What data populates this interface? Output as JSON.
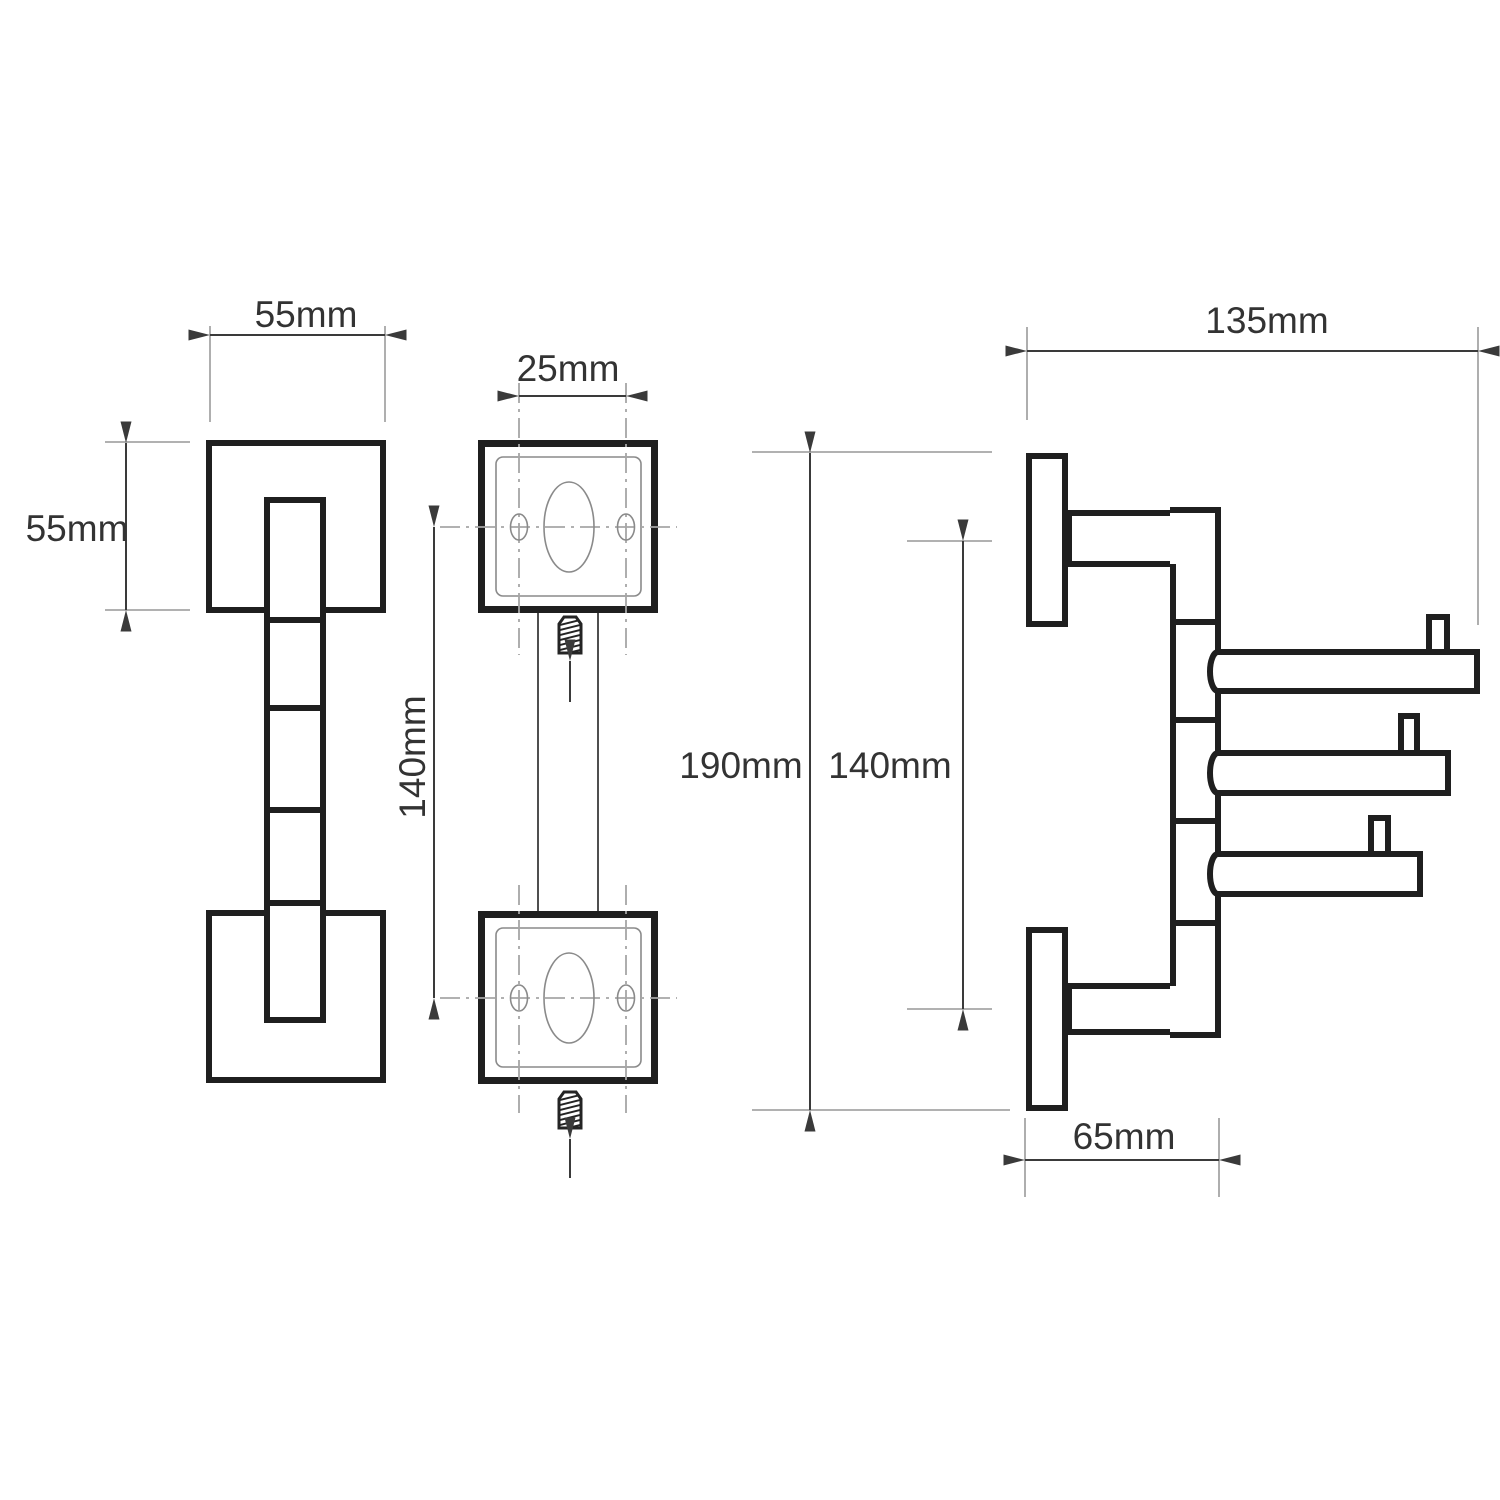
{
  "drawing": {
    "views": {
      "front": {
        "width_label": "55mm",
        "height_label": "55mm"
      },
      "mounting": {
        "hole_spacing_label": "25mm",
        "plate_distance_label": "140mm"
      },
      "side": {
        "depth_label": "135mm",
        "total_height_label": "190mm",
        "bracket_distance_label": "140mm",
        "wall_offset_label": "65mm"
      }
    }
  },
  "colors": {
    "bg": "#ffffff",
    "outline": "#1f1f1f",
    "dimension": "#3a3a3a",
    "extension": "#a6a6a6",
    "detail": "#8a8a8a",
    "thin": "#4f4f4f",
    "text": "#333333"
  }
}
